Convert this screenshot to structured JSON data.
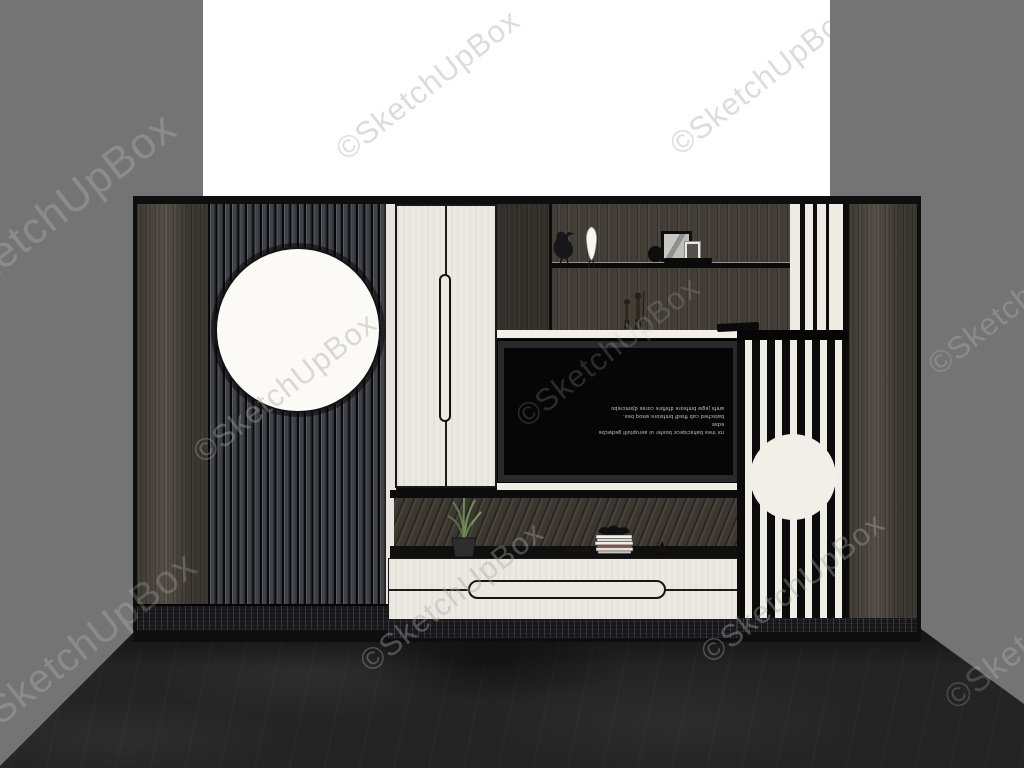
{
  "watermark": {
    "text": "©SketchUpBox",
    "instances": 10
  },
  "tv": {
    "screen_lines": [
      "roi ines bahsciqece bosfer ui aeruptuill gedwcbe edse",
      "batsched cab fhsdf bmfsiore wsoq bes.",
      "amfs jegw bmfsore dfsfbre corse djsmcrebo"
    ]
  },
  "scene": {
    "description": "3D rendered TV wall unit with slatted panels, circle accents and decor",
    "colors": {
      "wall": "#747474",
      "backdrop": "#ffffff",
      "floor": "#242424",
      "wood": "#4a453d",
      "wood_dark": "#433f38",
      "cream": "#eae8e0",
      "stripe_black": "#0b0b0b",
      "stripe_white": "#efede5",
      "circle_white": "#fbfaf7",
      "plant_green": "#6d8b55"
    },
    "objects": [
      "bird-figurine",
      "white-bird-figurine",
      "photo-frames",
      "black-vase",
      "wooden-figurines",
      "remote-control",
      "potted-plant",
      "sunglasses",
      "magazine-stack",
      "decor-bowl",
      "cone-ornament",
      "tv-screen",
      "moon-circle-left",
      "moon-circle-right"
    ]
  }
}
